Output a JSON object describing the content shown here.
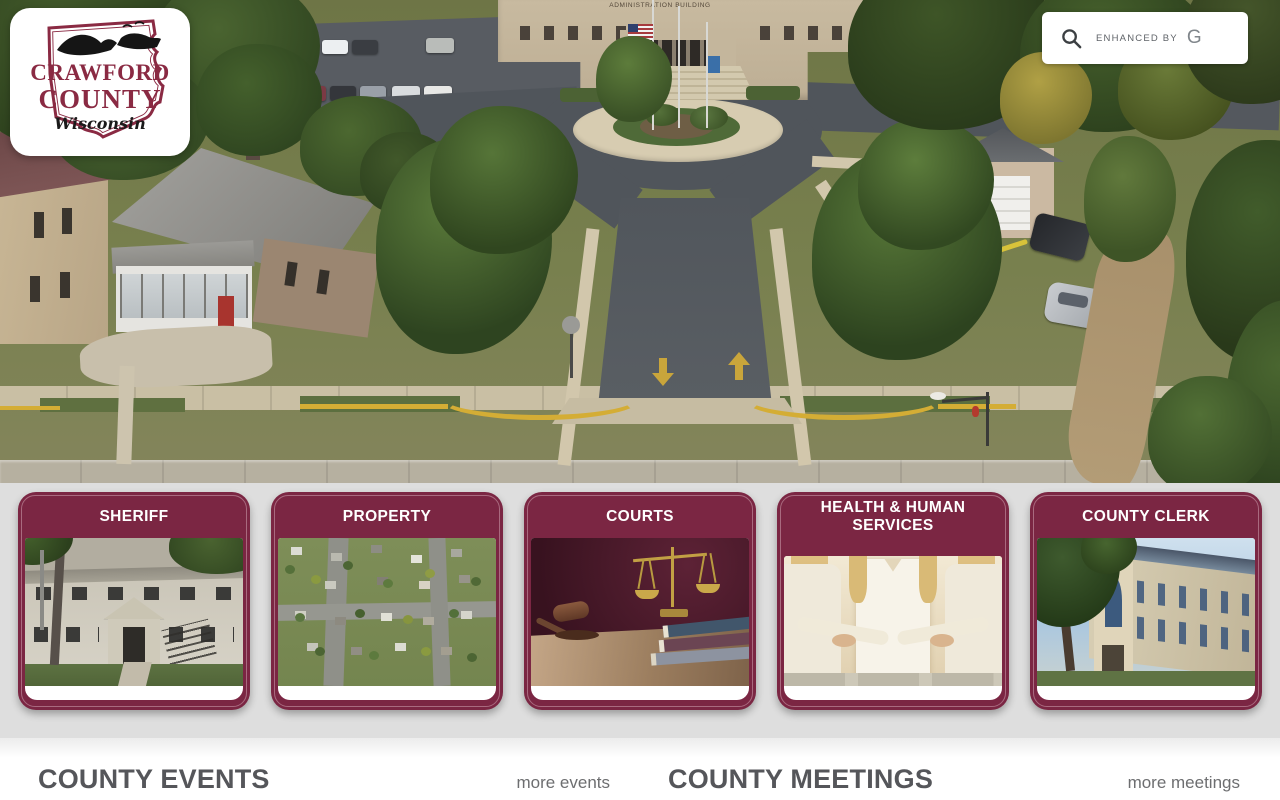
{
  "brand": {
    "line1": "CRAWFORD",
    "line2": "COUNTY",
    "line3": "Wisconsin"
  },
  "search": {
    "label": "ENHANCED BY",
    "provider_glyph": "G"
  },
  "hero": {
    "building_sign": "ADMINISTRATION BUILDING"
  },
  "cards": [
    {
      "label": "SHERIFF"
    },
    {
      "label": "PROPERTY"
    },
    {
      "label": "COURTS"
    },
    {
      "label": "HEALTH & HUMAN SERVICES"
    },
    {
      "label": "COUNTY CLERK"
    }
  ],
  "sections": {
    "events": {
      "title": "COUNTY EVENTS",
      "more_label": "more events"
    },
    "meetings": {
      "title": "COUNTY MEETINGS",
      "more_label": "more meetings"
    }
  },
  "colors": {
    "maroon": "#7b2643",
    "band_gray": "#dedede",
    "heading_gray": "#55565a",
    "link_gray": "#6d6e70",
    "curb_yellow": "#d4ad35"
  }
}
